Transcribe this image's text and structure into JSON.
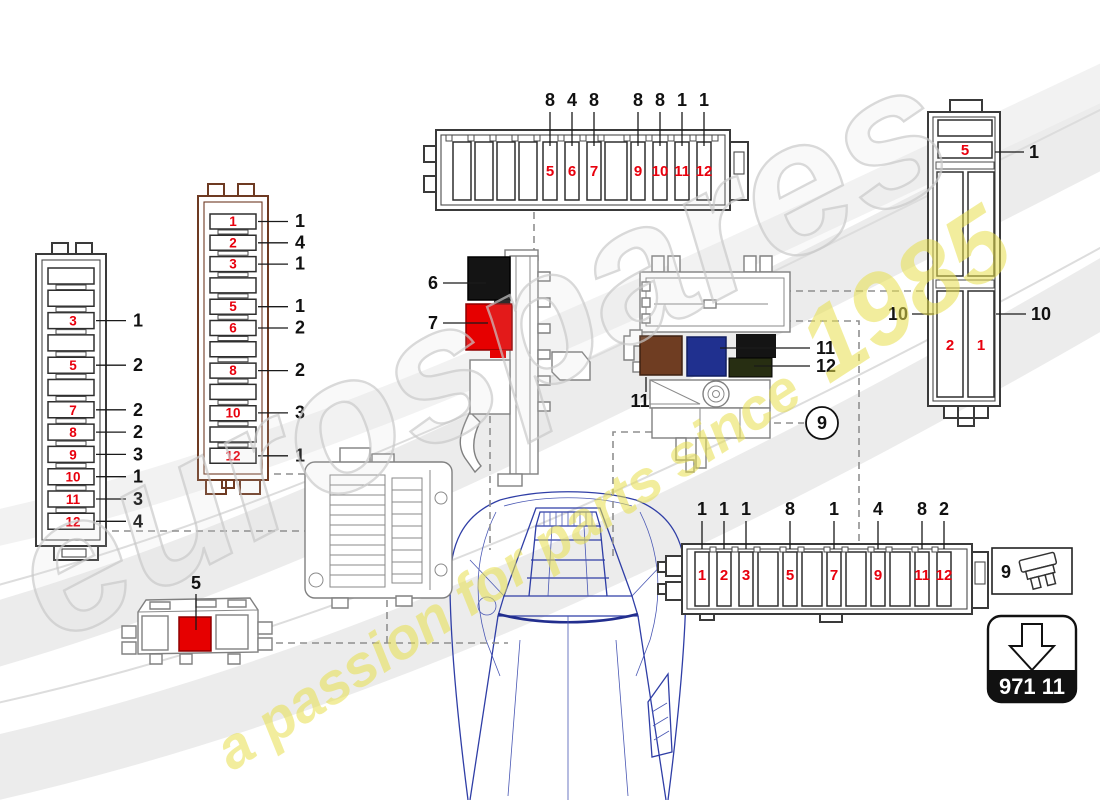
{
  "watermark": {
    "brand": "eurospares",
    "tagline": "a passion for parts since ",
    "year": "1985"
  },
  "colors": {
    "fuse_red": "#e8000d",
    "label_black": "#111111",
    "brown_housing": "#6e3a22",
    "relay_black": "#141414",
    "relay_red": "#e60000",
    "relay_brown": "#6f3d22",
    "relay_blue": "#20308f",
    "relay_olive": "#272e12",
    "car_blue": "#2f3ea6"
  },
  "left_block": {
    "fuses": [
      {
        "pos": "3",
        "ref": "1"
      },
      {
        "pos": "5",
        "ref": "2"
      },
      {
        "pos": "7",
        "ref": "2"
      },
      {
        "pos": "8",
        "ref": "2"
      },
      {
        "pos": "9",
        "ref": "3"
      },
      {
        "pos": "10",
        "ref": "1"
      },
      {
        "pos": "11",
        "ref": "3"
      },
      {
        "pos": "12",
        "ref": "4"
      }
    ]
  },
  "brown_block": {
    "fuses": [
      {
        "pos": "1",
        "ref": "1"
      },
      {
        "pos": "2",
        "ref": "4"
      },
      {
        "pos": "3",
        "ref": "1"
      },
      {
        "pos": "5",
        "ref": "1"
      },
      {
        "pos": "6",
        "ref": "2"
      },
      {
        "pos": "8",
        "ref": "2"
      },
      {
        "pos": "10",
        "ref": "3"
      },
      {
        "pos": "12",
        "ref": "1"
      }
    ]
  },
  "top_block": {
    "fuses": [
      {
        "pos": "5",
        "ref": "8"
      },
      {
        "pos": "6",
        "ref": "4"
      },
      {
        "pos": "7",
        "ref": "8"
      },
      {
        "pos": "9",
        "ref": "8"
      },
      {
        "pos": "10",
        "ref": "8"
      },
      {
        "pos": "11",
        "ref": "1"
      },
      {
        "pos": "12",
        "ref": "1"
      }
    ]
  },
  "bottom_block": {
    "fuses": [
      {
        "pos": "1",
        "ref": "1"
      },
      {
        "pos": "2",
        "ref": "1"
      },
      {
        "pos": "3",
        "ref": "1"
      },
      {
        "pos": "5",
        "ref": "8"
      },
      {
        "pos": "7",
        "ref": "1"
      },
      {
        "pos": "9",
        "ref": "4"
      },
      {
        "pos": "11",
        "ref": "8"
      },
      {
        "pos": "12",
        "ref": "2"
      }
    ]
  },
  "right_block": {
    "top_fuse": {
      "pos": "5",
      "ref": "1"
    },
    "big_fuses": [
      {
        "pos": "2",
        "ref": "10"
      },
      {
        "pos": "1",
        "ref": "10"
      }
    ]
  },
  "relay_bracket": {
    "black_relay_ref": "6",
    "red_relay_ref": "7"
  },
  "relay_plate": {
    "brown_relay_ref": "11",
    "blue_relay_ref": "11",
    "olive_relay_ref": "12"
  },
  "aux_relay_holder": {
    "relay_ref": "5"
  },
  "callout_circle": {
    "ref": "9"
  },
  "legend_box": {
    "ref": "9"
  },
  "part_box": {
    "code": "971 11"
  }
}
